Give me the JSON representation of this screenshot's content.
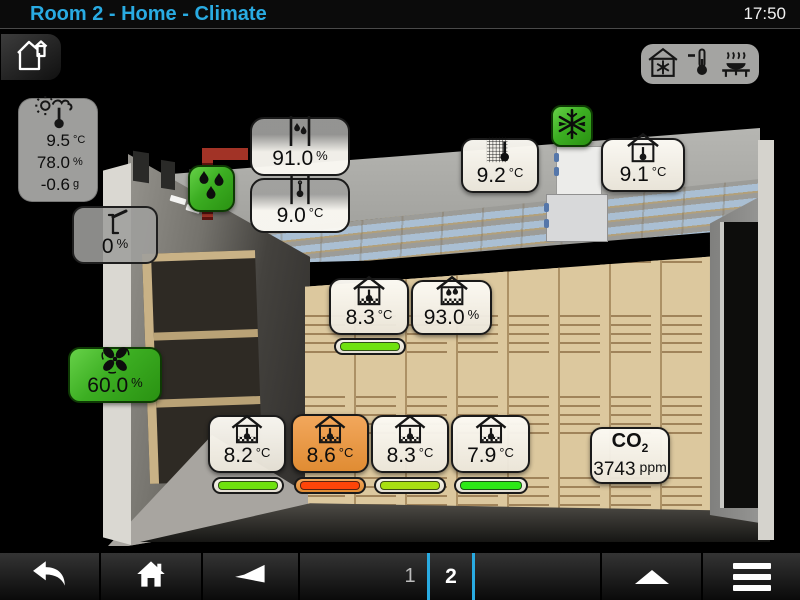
{
  "header": {
    "title": "Room 2 - Home - Climate",
    "time": "17:50"
  },
  "outside_station": {
    "temperature": "9.5",
    "temperature_unit": "°C",
    "humidity": "78.0",
    "humidity_unit": "%",
    "moisture_delta": "-0.6",
    "moisture_delta_unit": "g"
  },
  "hatch": {
    "value": "0",
    "unit": "%"
  },
  "fan": {
    "value": "60.0",
    "unit": "%"
  },
  "duct_humidity": {
    "value": "91.0",
    "unit": "%"
  },
  "duct_temperature": {
    "value": "9.0",
    "unit": "°C"
  },
  "coil_temperature": {
    "value": "9.2",
    "unit": "°C"
  },
  "room_temperature": {
    "value": "9.1",
    "unit": "°C"
  },
  "product_top": {
    "temperature": "8.3",
    "temperature_unit": "°C",
    "bar_color": "#6fe20e",
    "humidity": "93.0",
    "humidity_unit": "%"
  },
  "product_sensors": [
    {
      "value": "8.2",
      "unit": "°C",
      "bar_color": "#6fe20e",
      "alarm": false
    },
    {
      "value": "8.6",
      "unit": "°C",
      "bar_color": "#ff4508",
      "alarm": true
    },
    {
      "value": "8.3",
      "unit": "°C",
      "bar_color": "#a8e012",
      "alarm": false
    },
    {
      "value": "7.9",
      "unit": "°C",
      "bar_color": "#2de816",
      "alarm": false
    }
  ],
  "co2": {
    "label": "CO",
    "subscript": "2",
    "value": "3743",
    "unit": "ppm"
  },
  "nav": {
    "page1": "1",
    "page2": "2",
    "active_page": "2"
  },
  "colors": {
    "accent_cyan": "#29abe2",
    "active_green": "#3cae22",
    "alarm_orange": "#e08c33",
    "alarm_bar_red": "#ff4508"
  },
  "icons": {
    "top_left": "home-outline-icon",
    "modes": [
      "house-snowflake-icon",
      "thermometer-minus-icon",
      "steam-table-icon"
    ],
    "weather": "sun-cloud-thermometer-icon",
    "hatch": "vent-flap-icon",
    "fan": "fan-icon",
    "humidifier": "water-drops-icon",
    "cooling_active": "snowflake-icon",
    "nav": [
      "back-arrow-icon",
      "home-icon",
      "horn-icon",
      "up-triangle-icon",
      "menu-icon"
    ]
  }
}
